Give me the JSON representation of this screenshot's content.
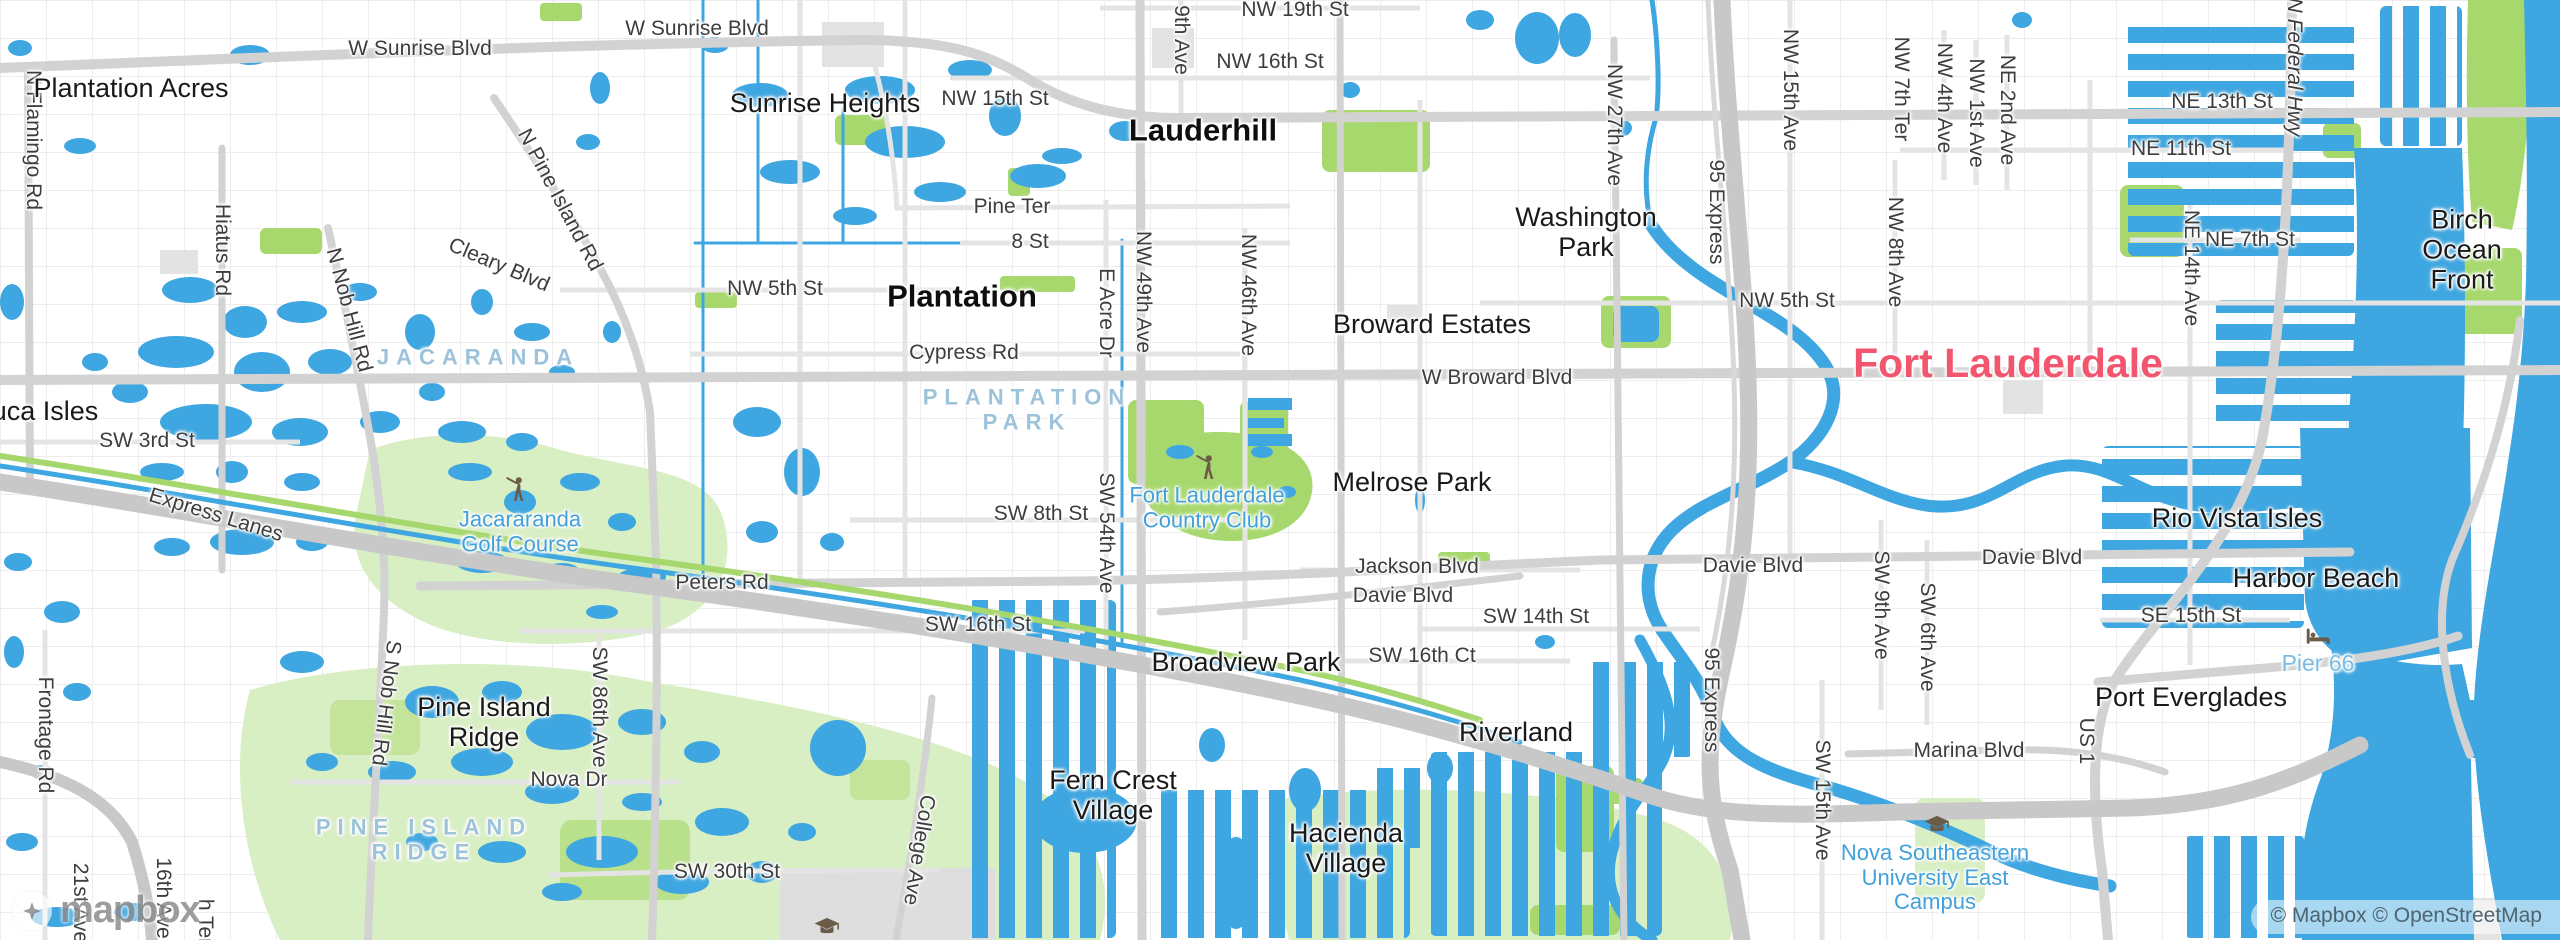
{
  "map": {
    "logo": "mapbox",
    "attribution": "© Mapbox © OpenStreetMap",
    "colors": {
      "water": "#3ea6e0",
      "park_bright": "#a7d86d",
      "park_pale": "#d8eec3",
      "road_major": "#d2d2d2",
      "road_minor": "#e4e4e4",
      "highway": "#c8c8c8",
      "city_major_label": "#f2566e",
      "poi_label": "#42a0da",
      "district_label": "#9dc3da",
      "icon_brown": "#6b5b48"
    },
    "labels": [
      {
        "id": "road-w-sunrise-blvd-1",
        "cls": "road",
        "x": 420,
        "y": 49,
        "text": "W Sunrise Blvd"
      },
      {
        "id": "road-w-sunrise-blvd-2",
        "cls": "road",
        "x": 697,
        "y": 29,
        "text": "W Sunrise Blvd"
      },
      {
        "id": "road-nw-19th-st",
        "cls": "road",
        "x": 1295,
        "y": 10,
        "text": "NW 19th St"
      },
      {
        "id": "road-nw-16th-st",
        "cls": "road",
        "x": 1270,
        "y": 62,
        "text": "NW 16th St"
      },
      {
        "id": "road-nw-15th-st",
        "cls": "road",
        "x": 995,
        "y": 99,
        "text": "NW 15th St"
      },
      {
        "id": "road-ne-13th-st",
        "cls": "road",
        "x": 2222,
        "y": 102,
        "text": "NE 13th St"
      },
      {
        "id": "road-ne-11th-st",
        "cls": "road",
        "x": 2181,
        "y": 149,
        "text": "NE 11th St"
      },
      {
        "id": "road-ne-7th-st",
        "cls": "road",
        "x": 2250,
        "y": 240,
        "text": "NE 7th St"
      },
      {
        "id": "road-pine-ter",
        "cls": "road",
        "x": 1012,
        "y": 207,
        "text": "Pine Ter"
      },
      {
        "id": "road-8-st",
        "cls": "road",
        "x": 1030,
        "y": 242,
        "text": "8 St"
      },
      {
        "id": "road-nw-5th-st-w",
        "cls": "road",
        "x": 775,
        "y": 289,
        "text": "NW 5th St"
      },
      {
        "id": "road-nw-5th-st-e",
        "cls": "road",
        "x": 1787,
        "y": 301,
        "text": "NW 5th St"
      },
      {
        "id": "road-cypress-rd",
        "cls": "road",
        "x": 964,
        "y": 353,
        "text": "Cypress Rd"
      },
      {
        "id": "road-w-broward-blvd",
        "cls": "road",
        "x": 1497,
        "y": 378,
        "text": "W Broward Blvd"
      },
      {
        "id": "road-sw-3rd-st",
        "cls": "road",
        "x": 147,
        "y": 441,
        "text": "SW 3rd St"
      },
      {
        "id": "road-express-lanes",
        "cls": "road",
        "x": 216,
        "y": 515,
        "rot": 17,
        "text": "Express Lanes"
      },
      {
        "id": "road-cleary-blvd",
        "cls": "road",
        "x": 499,
        "y": 265,
        "rot": 23,
        "text": "Cleary Blvd"
      },
      {
        "id": "road-peters-rd",
        "cls": "road",
        "x": 722,
        "y": 583,
        "text": "Peters Rd"
      },
      {
        "id": "road-sw-8th-st",
        "cls": "road",
        "x": 1041,
        "y": 514,
        "text": "SW 8th St"
      },
      {
        "id": "road-sw-16th-st",
        "cls": "road",
        "x": 978,
        "y": 625,
        "text": "SW 16th St"
      },
      {
        "id": "road-jackson-blvd",
        "cls": "road",
        "x": 1417,
        "y": 567,
        "text": "Jackson Blvd"
      },
      {
        "id": "road-davie-blvd-w",
        "cls": "road",
        "x": 1403,
        "y": 596,
        "text": "Davie Blvd"
      },
      {
        "id": "road-davie-blvd-m",
        "cls": "road",
        "x": 1753,
        "y": 566,
        "text": "Davie Blvd"
      },
      {
        "id": "road-davie-blvd-e",
        "cls": "road",
        "x": 2032,
        "y": 558,
        "text": "Davie Blvd"
      },
      {
        "id": "road-sw-14th-st",
        "cls": "road",
        "x": 1536,
        "y": 617,
        "text": "SW 14th St"
      },
      {
        "id": "road-sw-16th-ct",
        "cls": "road",
        "x": 1422,
        "y": 656,
        "text": "SW 16th Ct"
      },
      {
        "id": "road-se-15th-st",
        "cls": "road",
        "x": 2191,
        "y": 616,
        "text": "SE 15th St"
      },
      {
        "id": "road-marina-blvd",
        "cls": "road",
        "x": 1969,
        "y": 751,
        "text": "Marina Blvd"
      },
      {
        "id": "road-nova-dr",
        "cls": "road",
        "x": 569,
        "y": 780,
        "text": "Nova Dr"
      },
      {
        "id": "road-sw-30th-st",
        "cls": "road",
        "x": 727,
        "y": 872,
        "text": "SW 30th St"
      },
      {
        "id": "road-n-flamingo-rd",
        "cls": "road",
        "x": 33,
        "y": 140,
        "rot": 90,
        "text": "N Flamingo Rd"
      },
      {
        "id": "road-hiatus-rd",
        "cls": "road",
        "x": 222,
        "y": 250,
        "rot": 90,
        "text": "Hiatus Rd"
      },
      {
        "id": "road-n-nob-hill-rd",
        "cls": "road",
        "x": 349,
        "y": 310,
        "rot": 75,
        "text": "N Nob Hill Rd"
      },
      {
        "id": "road-n-pine-island-rd",
        "cls": "road",
        "x": 560,
        "y": 200,
        "rot": 62,
        "text": "N Pine Island Rd"
      },
      {
        "id": "road-9th-ave",
        "cls": "road",
        "x": 1181,
        "y": 40,
        "rot": 90,
        "text": "9th Ave"
      },
      {
        "id": "road-nw-27th-ave",
        "cls": "road",
        "x": 1614,
        "y": 125,
        "rot": 90,
        "text": "NW 27th Ave"
      },
      {
        "id": "road-95-express-n",
        "cls": "road",
        "x": 1716,
        "y": 212,
        "rot": 90,
        "text": "95 Express"
      },
      {
        "id": "road-nw-15th-ave",
        "cls": "road",
        "x": 1790,
        "y": 90,
        "rot": 90,
        "text": "NW 15th Ave"
      },
      {
        "id": "road-nw-7th-ter",
        "cls": "road",
        "x": 1901,
        "y": 89,
        "rot": 90,
        "text": "NW 7th Ter"
      },
      {
        "id": "road-nw-4th-ave",
        "cls": "road",
        "x": 1944,
        "y": 98,
        "rot": 90,
        "text": "NW 4th Ave"
      },
      {
        "id": "road-nw-1st-ave",
        "cls": "road",
        "x": 1976,
        "y": 113,
        "rot": 90,
        "text": "NW 1st Ave"
      },
      {
        "id": "road-ne-2nd-ave",
        "cls": "road",
        "x": 2007,
        "y": 110,
        "rot": 90,
        "text": "NE 2nd Ave"
      },
      {
        "id": "road-nw-8th-ave",
        "cls": "road",
        "x": 1895,
        "y": 252,
        "rot": 90,
        "text": "NW 8th Ave"
      },
      {
        "id": "road-n-federal-hwy",
        "cls": "road-it",
        "x": 2294,
        "y": 67,
        "rot": 90,
        "text": "N Federal Hwy"
      },
      {
        "id": "road-ne-14th-ave",
        "cls": "road",
        "x": 2191,
        "y": 268,
        "rot": 90,
        "text": "NE 14th Ave"
      },
      {
        "id": "road-e-acre-dr",
        "cls": "road",
        "x": 1106,
        "y": 313,
        "rot": 90,
        "text": "E Acre Dr"
      },
      {
        "id": "road-nw-49th-ave",
        "cls": "road",
        "x": 1143,
        "y": 292,
        "rot": 90,
        "text": "NW 49th Ave"
      },
      {
        "id": "road-nw-46th-ave",
        "cls": "road",
        "x": 1248,
        "y": 295,
        "rot": 90,
        "text": "NW 46th Ave"
      },
      {
        "id": "road-sw-54th-ave",
        "cls": "road",
        "x": 1106,
        "y": 533,
        "rot": 90,
        "text": "SW 54th Ave"
      },
      {
        "id": "road-95-express-s",
        "cls": "road",
        "x": 1711,
        "y": 700,
        "rot": 90,
        "text": "95 Express"
      },
      {
        "id": "road-sw-9th-ave",
        "cls": "road",
        "x": 1881,
        "y": 605,
        "rot": 90,
        "text": "SW 9th Ave"
      },
      {
        "id": "road-sw-6th-ave",
        "cls": "road",
        "x": 1927,
        "y": 637,
        "rot": 90,
        "text": "SW 6th Ave"
      },
      {
        "id": "road-sw-15th-ave",
        "cls": "road",
        "x": 1822,
        "y": 800,
        "rot": 90,
        "text": "SW 15th Ave"
      },
      {
        "id": "road-us-1",
        "cls": "road",
        "x": 2086,
        "y": 741,
        "rot": 90,
        "text": "US 1"
      },
      {
        "id": "road-sw-86th-ave",
        "cls": "road",
        "x": 599,
        "y": 707,
        "rot": 90,
        "text": "SW 86th Ave"
      },
      {
        "id": "road-s-nob-hill-rd",
        "cls": "road",
        "x": 386,
        "y": 703,
        "rot": 97,
        "text": "S Nob Hill Rd"
      },
      {
        "id": "road-college-ave",
        "cls": "road",
        "x": 919,
        "y": 850,
        "rot": 99,
        "text": "College Ave"
      },
      {
        "id": "road-frontage-rd",
        "cls": "road",
        "x": 45,
        "y": 735,
        "rot": 90,
        "text": "Frontage Rd"
      },
      {
        "id": "road-21st-ave",
        "cls": "road",
        "x": 80,
        "y": 903,
        "rot": 90,
        "text": "21st Ave"
      },
      {
        "id": "road-16th-ave",
        "cls": "road",
        "x": 163,
        "y": 898,
        "rot": 90,
        "text": "16th Ave"
      },
      {
        "id": "road-h-ter",
        "cls": "road",
        "x": 205,
        "y": 922,
        "rot": 90,
        "text": "h Ter"
      },
      {
        "id": "place-plantation-acres",
        "cls": "nbhd",
        "x": 131,
        "y": 88,
        "text": "Plantation Acres"
      },
      {
        "id": "place-sunrise-heights",
        "cls": "nbhd",
        "x": 825,
        "y": 103,
        "text": "Sunrise Heights"
      },
      {
        "id": "place-lauderhill",
        "cls": "city",
        "x": 1203,
        "y": 131,
        "text": "Lauderhill"
      },
      {
        "id": "place-washington-park",
        "cls": "nbhd",
        "x": 1586,
        "y": 232,
        "text": "Washington\nPark"
      },
      {
        "id": "place-plantation",
        "cls": "city",
        "x": 962,
        "y": 297,
        "text": "Plantation"
      },
      {
        "id": "place-broward-estates",
        "cls": "nbhd",
        "x": 1432,
        "y": 324,
        "text": "Broward Estates"
      },
      {
        "id": "place-fort-lauderdale",
        "cls": "city-major",
        "x": 2008,
        "y": 364,
        "text": "Fort Lauderdale"
      },
      {
        "id": "place-melrose-park",
        "cls": "nbhd",
        "x": 1412,
        "y": 482,
        "text": "Melrose Park"
      },
      {
        "id": "place-broadview-park",
        "cls": "nbhd",
        "x": 1246,
        "y": 662,
        "text": "Broadview Park"
      },
      {
        "id": "place-riverland",
        "cls": "nbhd",
        "x": 1516,
        "y": 732,
        "text": "Riverland"
      },
      {
        "id": "place-pine-island-ridge",
        "cls": "nbhd",
        "x": 484,
        "y": 722,
        "text": "Pine Island\nRidge"
      },
      {
        "id": "place-fern-crest-village",
        "cls": "nbhd",
        "x": 1113,
        "y": 795,
        "text": "Fern Crest\nVillage"
      },
      {
        "id": "place-hacienda-village",
        "cls": "nbhd",
        "x": 1346,
        "y": 848,
        "text": "Hacienda\nVillage"
      },
      {
        "id": "place-birch-ocean-front",
        "cls": "nbhd",
        "x": 2462,
        "y": 250,
        "text": "Birch Ocean\nFront"
      },
      {
        "id": "place-rio-vista-isles",
        "cls": "nbhd",
        "x": 2237,
        "y": 518,
        "text": "Rio Vista Isles"
      },
      {
        "id": "place-harbor-beach",
        "cls": "nbhd",
        "x": 2316,
        "y": 578,
        "text": "Harbor Beach"
      },
      {
        "id": "place-port-everglades",
        "cls": "nbhd",
        "x": 2191,
        "y": 697,
        "text": "Port Everglades"
      },
      {
        "id": "place-uca-isles",
        "cls": "nbhd",
        "x": 45,
        "y": 411,
        "text": "uca Isles"
      },
      {
        "id": "district-jacaranda",
        "cls": "district",
        "x": 478,
        "y": 358,
        "text": "JACARANDA"
      },
      {
        "id": "district-plantation-park",
        "cls": "district",
        "x": 1027,
        "y": 410,
        "text": "PLANTATION\nPARK"
      },
      {
        "id": "district-pine-island-ridge",
        "cls": "district",
        "x": 424,
        "y": 840,
        "text": "PINE ISLAND\nRIDGE"
      },
      {
        "id": "poi-jacararanda-golf-course",
        "cls": "poi",
        "x": 520,
        "y": 532,
        "text": "Jacararanda\nGolf Course"
      },
      {
        "id": "poi-fort-lauderdale-country-club",
        "cls": "poi",
        "x": 1207,
        "y": 508,
        "text": "Fort Lauderdale\nCountry Club"
      },
      {
        "id": "poi-pier-66",
        "cls": "poi-light",
        "x": 2318,
        "y": 664,
        "text": "Pier 66"
      },
      {
        "id": "poi-nova-southeastern-university",
        "cls": "poi",
        "x": 1935,
        "y": 878,
        "text": "Nova Southeastern\nUniversity East\nCampus"
      }
    ],
    "icons": [
      {
        "type": "golfer",
        "x": 516,
        "y": 490
      },
      {
        "type": "golfer",
        "x": 1206,
        "y": 468
      },
      {
        "type": "lodging",
        "x": 2318,
        "y": 637
      },
      {
        "type": "grad-cap",
        "x": 1937,
        "y": 826
      },
      {
        "type": "grad-cap",
        "x": 827,
        "y": 928
      }
    ]
  }
}
